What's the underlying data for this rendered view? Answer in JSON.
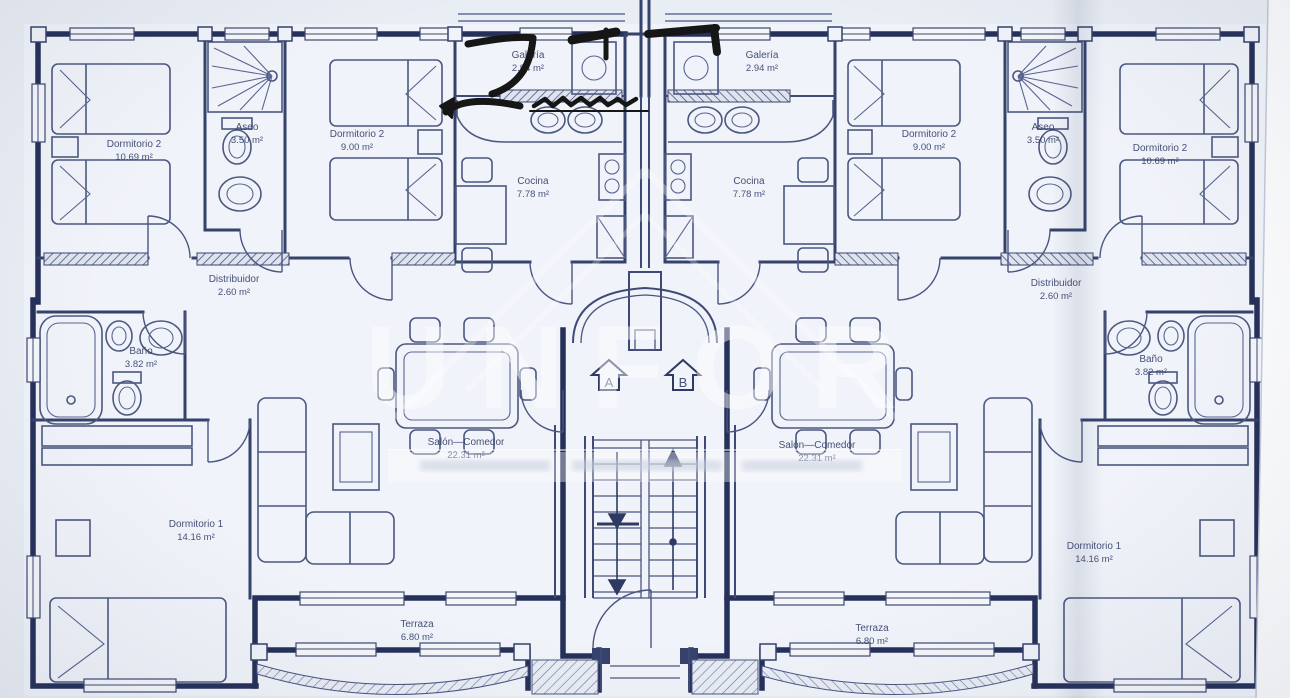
{
  "rooms": {
    "galeria": {
      "name": "Galería",
      "area": "2.94 m²"
    },
    "dormitorio2a": {
      "name": "Dormitorio 2",
      "area": "10.69 m²"
    },
    "aseo": {
      "name": "Aseo",
      "area": "3.50 m²"
    },
    "dormitorio2b": {
      "name": "Dormitorio 2",
      "area": "9.00 m²"
    },
    "cocina": {
      "name": "Cocina",
      "area": "7.78 m²"
    },
    "distribuidor": {
      "name": "Distribuidor",
      "area": "2.60 m²"
    },
    "bano": {
      "name": "Baño",
      "area": "3.82 m²"
    },
    "salon": {
      "name": "Salón—Comedor",
      "area": "22.31 m²"
    },
    "dormitorio1": {
      "name": "Dormitorio 1",
      "area": "14.16 m²"
    },
    "terraza": {
      "name": "Terraza",
      "area": "6.80 m²"
    }
  },
  "markers": {
    "unit_a": "A",
    "unit_b": "B"
  },
  "watermark": {
    "text": "UNFOR"
  },
  "colors": {
    "ink": "#35426c",
    "paper": "#f0f3f9",
    "annotation": "#161616"
  }
}
